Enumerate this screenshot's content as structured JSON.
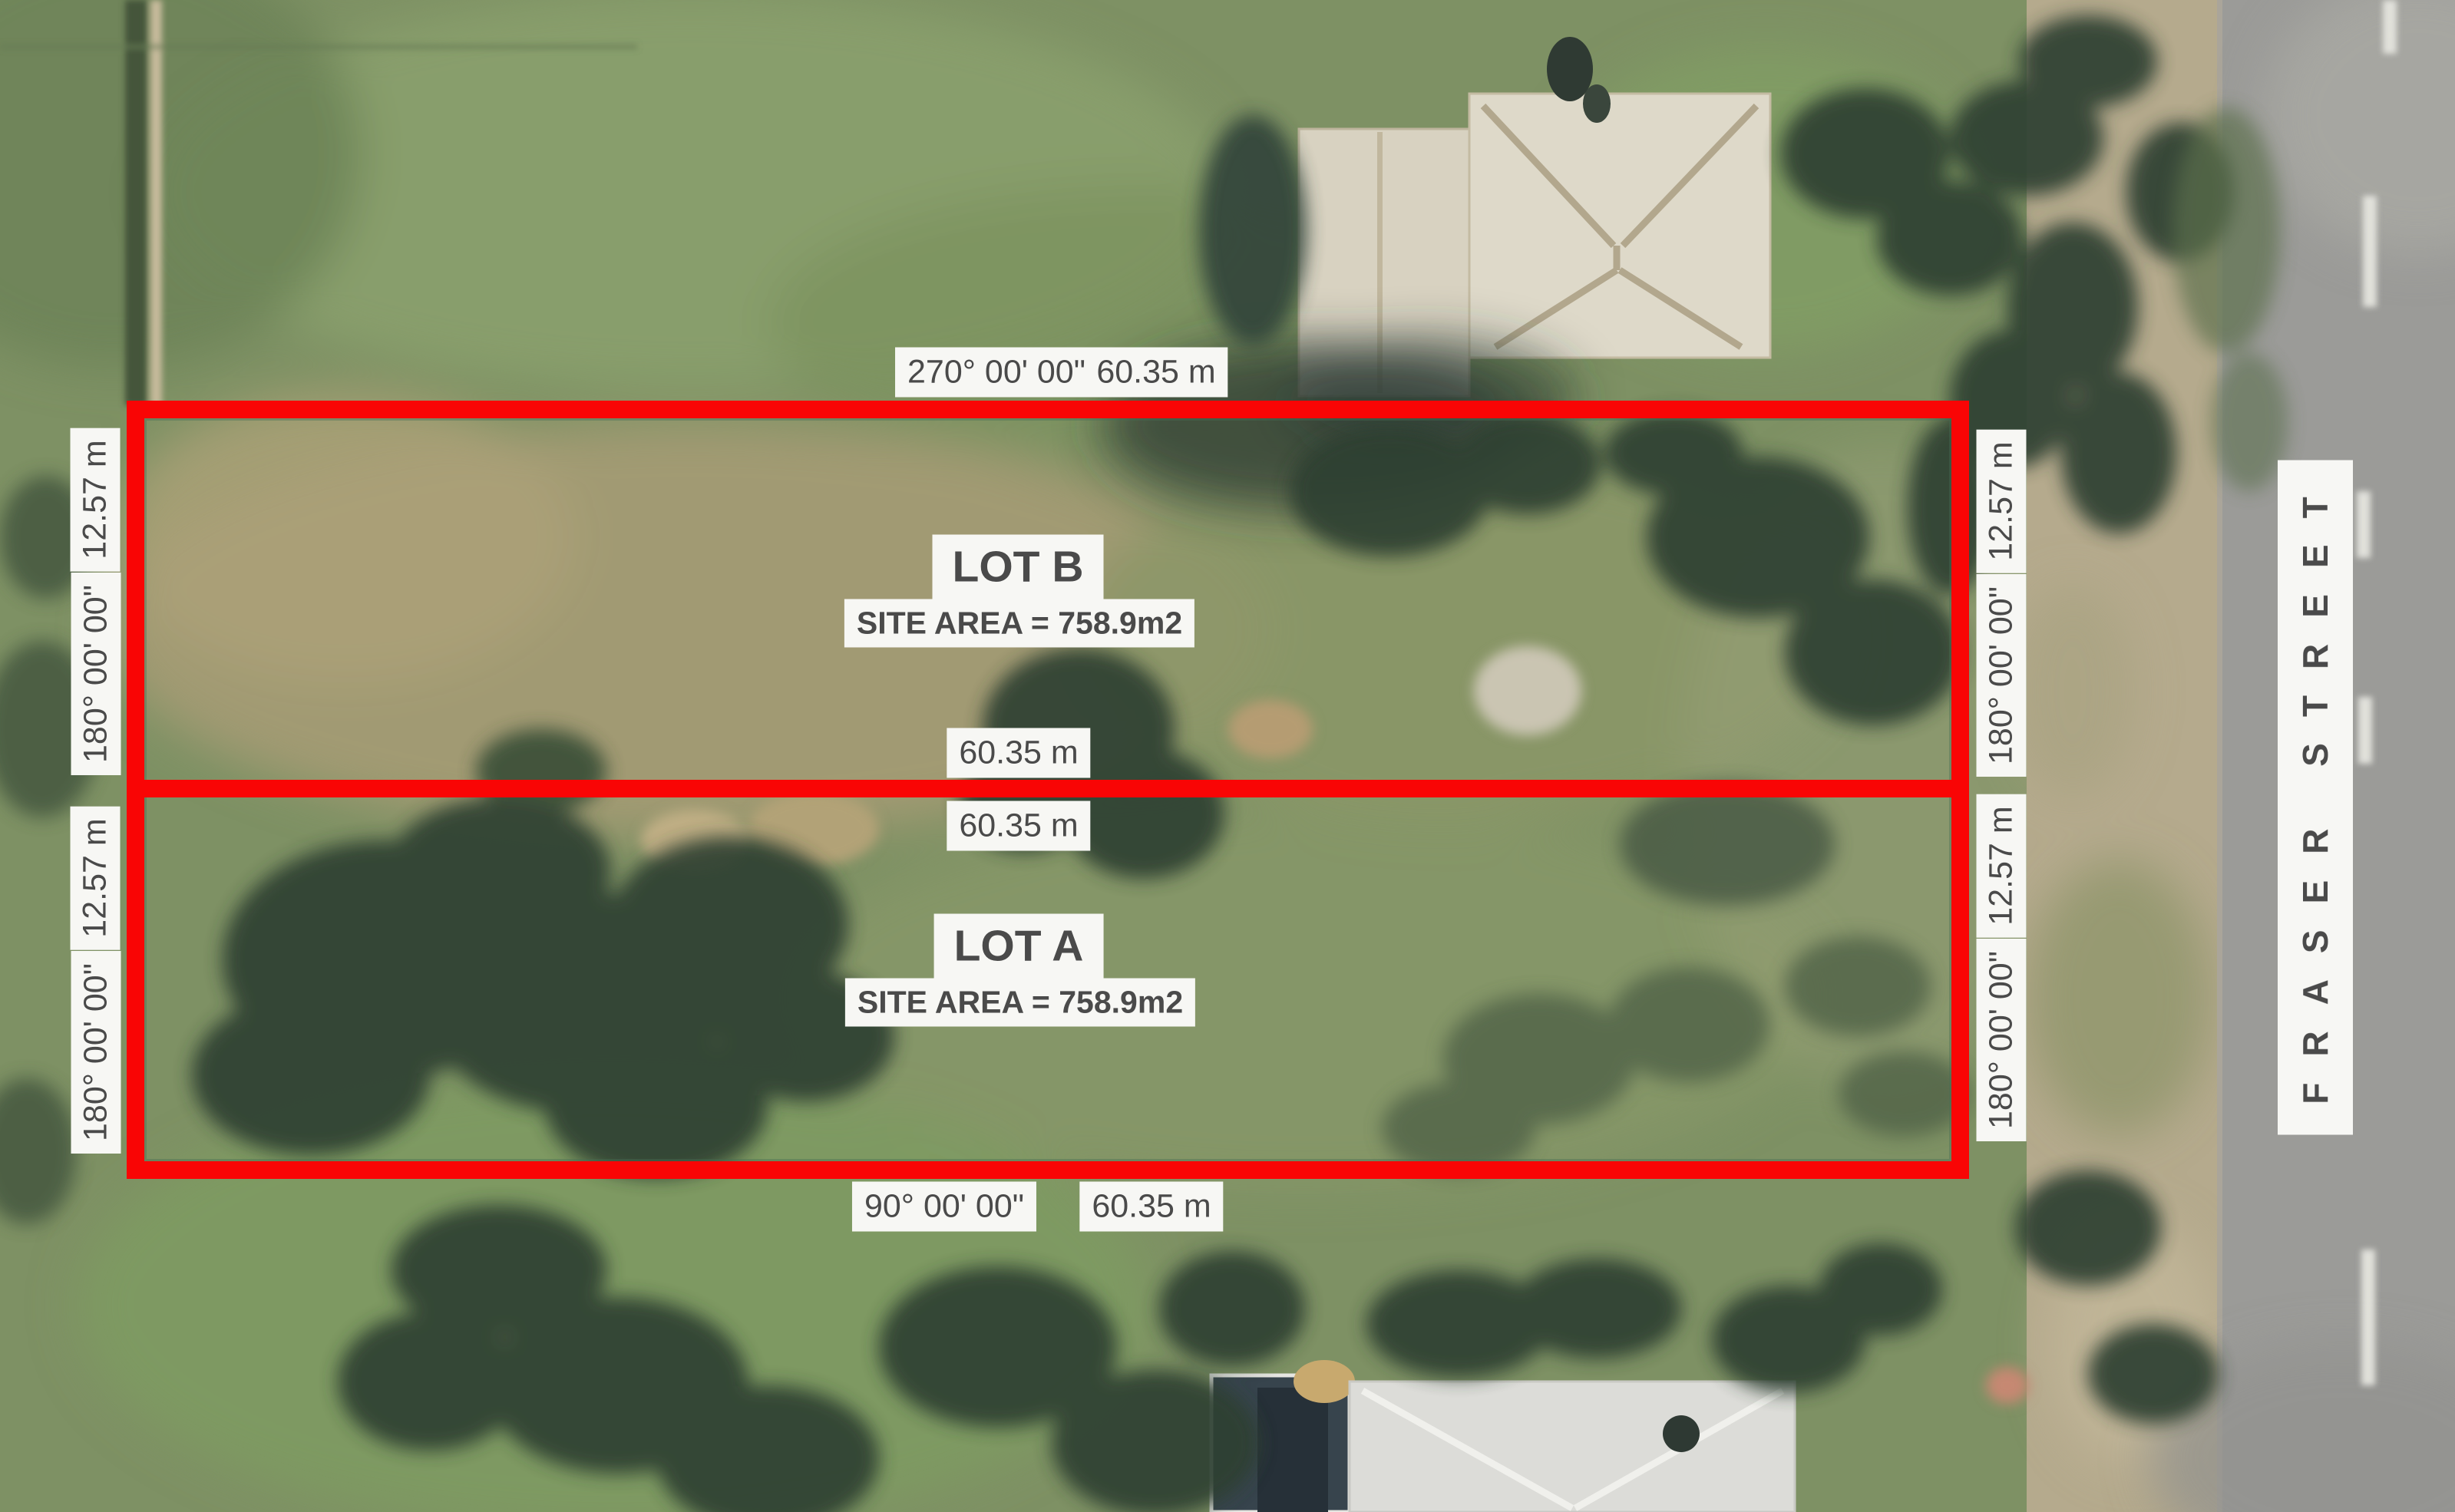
{
  "plan": {
    "street": "FRASER STREET",
    "lots": [
      {
        "name": "LOT B",
        "area": "SITE AREA = 758.9m2"
      },
      {
        "name": "LOT A",
        "area": "SITE AREA = 758.9m2"
      }
    ],
    "labels": {
      "top": {
        "bearing": "270° 00' 00\"",
        "distance": "60.35 m"
      },
      "middle": {
        "upper_distance": "60.35 m",
        "lower_distance": "60.35 m"
      },
      "bottom": {
        "bearing": "90° 00' 00\"",
        "distance": "60.35 m"
      },
      "sides": {
        "left_lot_b": {
          "width": "12.57 m",
          "bearing": "180° 00' 00\""
        },
        "left_lot_a": {
          "width": "12.57 m",
          "bearing": "180° 00' 00\""
        },
        "right_lot_b": {
          "width": "12.57 m",
          "bearing": "180° 00' 00\""
        },
        "right_lot_a": {
          "width": "12.57 m",
          "bearing": "180° 00' 00\""
        }
      }
    },
    "colors": {
      "boundary_red": "#F90505",
      "label_background": "#F7F7F4",
      "label_text": "#4A4A4A"
    }
  }
}
